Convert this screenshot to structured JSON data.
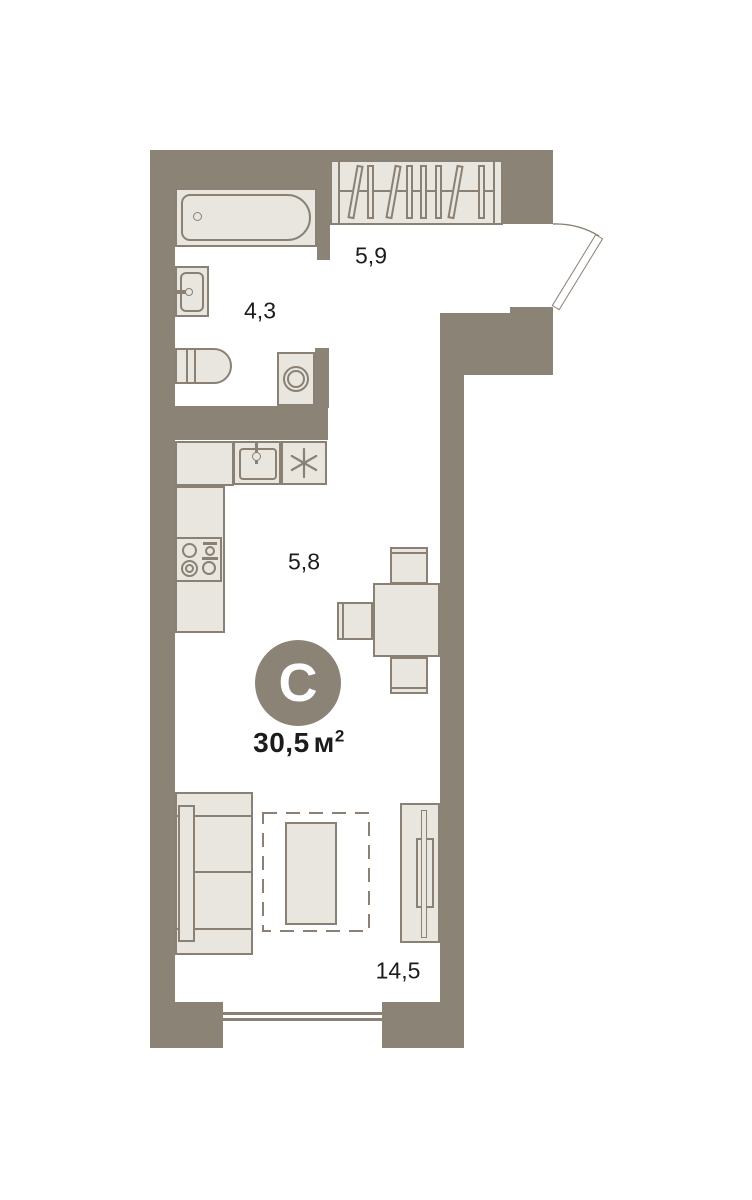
{
  "plan": {
    "badge": {
      "letter": "С"
    },
    "total_area": {
      "value": "30,5",
      "unit": "м",
      "sup": "2"
    },
    "rooms": {
      "hallway": {
        "area": "5,9"
      },
      "bathroom": {
        "area": "4,3"
      },
      "kitchen": {
        "area": "5,8"
      },
      "living": {
        "area": "14,5"
      }
    },
    "fixtures": [
      "bathtub",
      "wardrobe",
      "washbasin",
      "toilet",
      "washing-machine",
      "kitchen-counter",
      "kitchen-sink",
      "hob-asterisk",
      "stove",
      "dining-table",
      "chair",
      "sofa",
      "rug",
      "coffee-table",
      "tv-stand",
      "tv",
      "entry-door",
      "window"
    ],
    "colors": {
      "wall": "#8C8377",
      "line": "#8A8174",
      "fill": "#E9E6E0",
      "floor": "#FFFFFF",
      "text": "#1C1C1C",
      "badge_text": "#FFFFFF"
    }
  }
}
